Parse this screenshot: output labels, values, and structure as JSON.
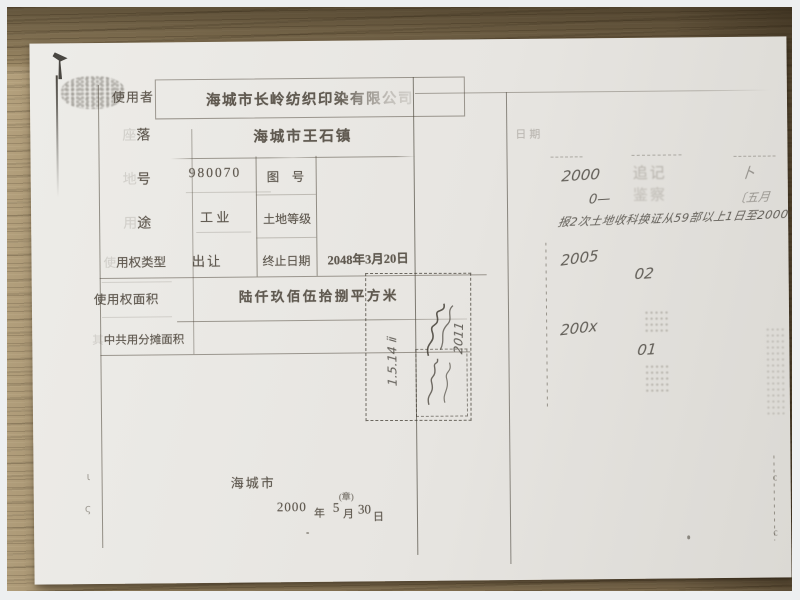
{
  "colors": {
    "paper": "#e9e7e3",
    "wood": "#8f7c5c",
    "ink": "#4e473d",
    "frame": "#edeff0"
  },
  "form": {
    "rows": [
      {
        "faint": "",
        "label": "使用者",
        "value": "海城市长岭纺织印染有限公司"
      },
      {
        "faint": "座",
        "label": "落",
        "value": "海城市王石镇"
      },
      {
        "faint": "地",
        "label": "号",
        "value": "980070",
        "cell2": "图　号"
      },
      {
        "faint": "用",
        "label": "途",
        "value": "工 业",
        "cell2": "土地等级"
      },
      {
        "faint": "使",
        "label": "用权类型",
        "value": "出让",
        "cell2": "终止日期",
        "cell2_value": "2048年3月20日"
      },
      {
        "faint": "",
        "label": "使用权面积",
        "value": "陆仟玖佰伍拾捌平方米"
      },
      {
        "faint": "其",
        "label": "中共用分摊面积",
        "value": ""
      }
    ],
    "issuer": "海城市",
    "date": {
      "year": "2000",
      "y": "年",
      "month": "5",
      "seal": "(章)",
      "m": "月",
      "day": "30",
      "d": "日"
    }
  },
  "right_column": {
    "header": "日期",
    "hw_2000": "2000",
    "hw_0": "0—",
    "stamp_top": "追记",
    "stamp_bottom": "鉴察",
    "hw_bu": "卜",
    "hw_wuyue": "〔五月",
    "hw_line": "报2次土地收科换证从59部以上1日至2000年计.",
    "hw_2005": "2005",
    "hw_02": "02",
    "hw_200x": "200x",
    "hw_01": "01"
  },
  "stamp_box": {
    "hw_date": "1.5.14 ⅱ",
    "hw_year": "2011"
  },
  "edge_marks": {
    "left_a": "ι",
    "left_b": "ς",
    "right_a": "c",
    "right_b": "c"
  }
}
